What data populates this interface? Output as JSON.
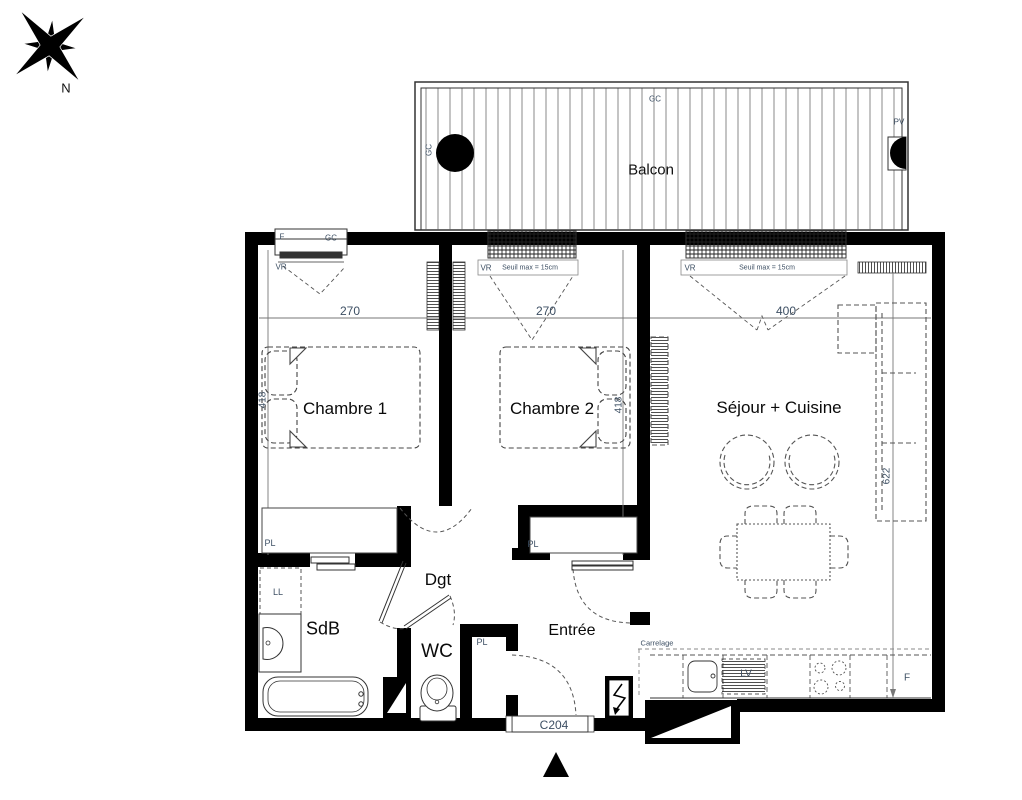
{
  "compass": {
    "north_label": "N"
  },
  "balcony": {
    "label": "Balcon",
    "gc_left": "GC",
    "gc_top": "GC",
    "pv": "PV"
  },
  "windows": {
    "w1_f": "F",
    "w1_gc": "GC",
    "w1_vr": "VR",
    "w2_vr": "VR",
    "w2_seuil": "Seuil max = 15cm",
    "w3_vr": "VR",
    "w3_seuil": "Seuil max = 15cm"
  },
  "rooms": {
    "chambre1": "Chambre 1",
    "chambre2": "Chambre 2",
    "sejour": "Séjour + Cuisine",
    "sdb": "SdB",
    "wc": "WC",
    "dgt": "Dgt",
    "entree": "Entrée"
  },
  "dimensions_cm": {
    "chambre1_width": "270",
    "chambre2_width": "270",
    "sejour_width": "400",
    "chambre1_depth": "418",
    "chambre2_depth": "418",
    "sejour_depth": "622"
  },
  "labels": {
    "pl_chambre1": "PL",
    "pl_chambre2": "PL",
    "pl_entree": "PL",
    "washer": "LL",
    "dishwasher": "LV",
    "fridge": "F",
    "floor_note": "Carrelage"
  },
  "entrance": {
    "door_code": "C204"
  },
  "colors": {
    "wall": "#000000",
    "label_text": "#3d4f63",
    "room_text": "#0a0a0a",
    "line": "#555555"
  }
}
